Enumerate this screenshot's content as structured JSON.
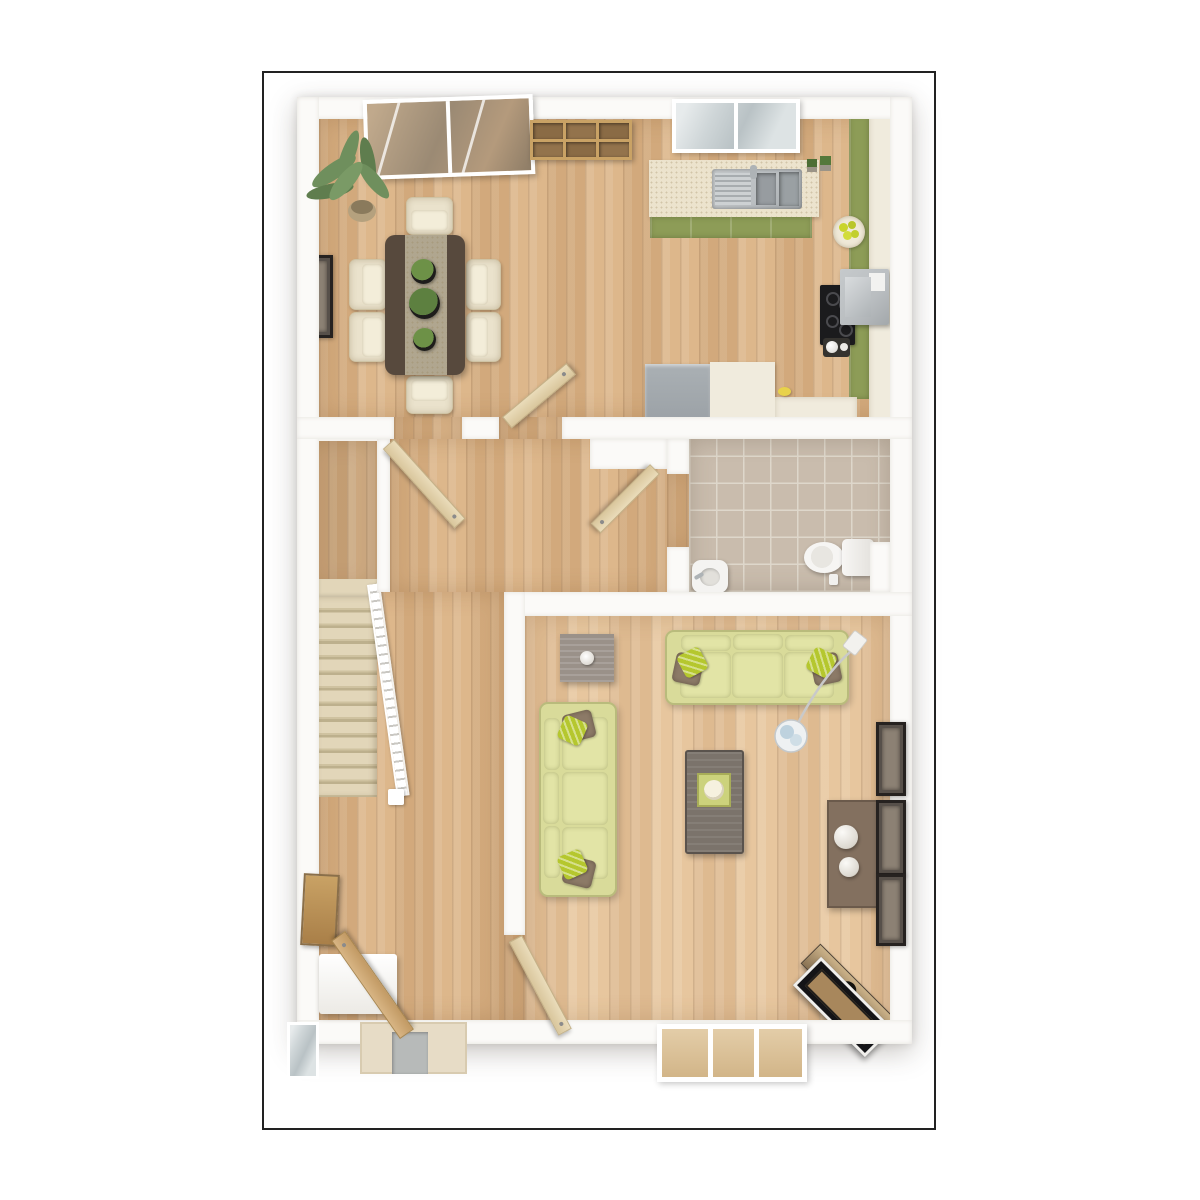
{
  "scene": {
    "kind": "3d-floor-plan-render",
    "view": "top-down dollhouse",
    "storey": "ground floor",
    "text_visible": false,
    "background": "#ffffff"
  },
  "palette": {
    "frame_line": "#222222",
    "wall": "#fbfaf8",
    "wood_a": "#d9b184",
    "wood_b": "#e4c198",
    "carpet": "#e2d6b9",
    "tile": "#c9bcad",
    "tile_grout": "#ded7cb",
    "green_cab": "#8d9c57",
    "counter": "#ece3cd",
    "steel": "#b9bdc0",
    "sofa": "#d9db9a",
    "sofa_cushion": "#e2e4a6",
    "pillow_lime": "#b5c72e",
    "pillow_brown": "#8c7a67",
    "table_dark": "#57493d",
    "table_runner": "#b0a68f",
    "chair": "#eae2cc",
    "leaf_cream": "#eadcba",
    "door_oak": "#d8b584",
    "glass_cool": "#cfd6d8",
    "glass_warm": "#e3cda8",
    "sideboard": "#83705f",
    "tv_black": "#141417",
    "cream_unit": "#f0ebdd",
    "gray_appliance": "#9aa0a5"
  },
  "rooms": [
    {
      "id": "kitchen-dining",
      "contents": [
        "french patio doors",
        "wall cube shelves",
        "kitchen window",
        "L-shaped worktop with sink and drainer",
        "green base cabinets",
        "tall cream units",
        "hob with extractor-microwave",
        "kettle",
        "fruit bowl",
        "herb pots",
        "grey appliance",
        "dining table with runner and three planters",
        "six cream chairs",
        "potted palm",
        "wall picture"
      ]
    },
    {
      "id": "hallway",
      "contents": [
        "two open doors to kitchen-diner",
        "under-stairs closet",
        "carpeted staircase with white banister",
        "wall art panel",
        "white hall bench",
        "open front door",
        "door mat",
        "sidelight"
      ]
    },
    {
      "id": "wc",
      "contents": [
        "beige floor tiles",
        "toilet",
        "hand basin",
        "open door"
      ]
    },
    {
      "id": "living-room",
      "contents": [
        "three-seat sofa",
        "second sofa",
        "square side table with candle",
        "coffee table with tray",
        "arc floor lamp",
        "sideboard with two spheres",
        "three wall frames",
        "corner TV unit",
        "triple window",
        "open door to hall"
      ]
    }
  ]
}
